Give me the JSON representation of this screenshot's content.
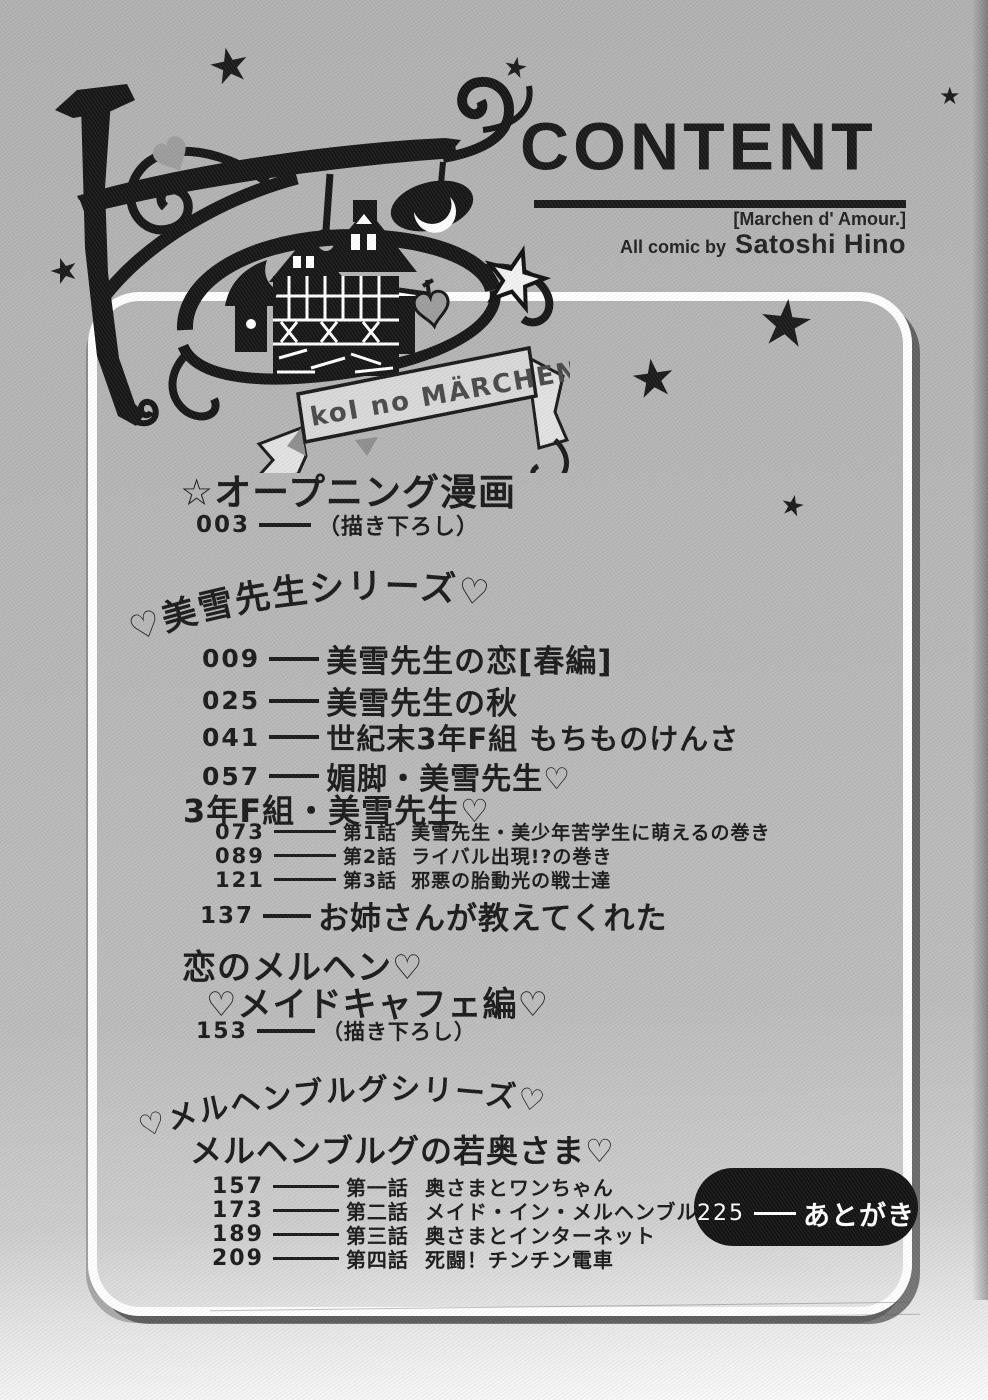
{
  "header": {
    "title": "CONTENT",
    "subtitle": "[Marchen d' Amour.]",
    "byline_prefix": "All comic by",
    "author": "Satoshi Hino"
  },
  "illustration": {
    "banner_text": "koI no MÄRCHEN"
  },
  "icons": {
    "star": "★"
  },
  "colors": {
    "paper": "#b7b7b7",
    "ink": "#1b1b1b",
    "frame": "#ffffff",
    "pill": "#141414",
    "banner_fill": "#d9d9d9",
    "heart_gray": "#9d9d9d"
  },
  "toc": {
    "opening": {
      "title": "☆オープニング漫画",
      "page": "003",
      "note": "（描き下ろし）"
    },
    "miyuki_series": {
      "arc_heading": "♡美雪先生シリーズ♡",
      "items": [
        {
          "page": "009",
          "title": "美雪先生の恋[春編]"
        },
        {
          "page": "025",
          "title": "美雪先生の秋"
        },
        {
          "page": "041",
          "title": "世紀末3年F組 もちものけんさ"
        },
        {
          "page": "057",
          "title": "媚脚・美雪先生♡"
        }
      ],
      "subseries": {
        "title": "3年F組・美雪先生♡",
        "episodes": [
          {
            "page": "073",
            "label": "第1話",
            "title": "美雪先生・美少年苦学生に萌えるの巻き"
          },
          {
            "page": "089",
            "label": "第2話",
            "title": "ライバル出現!?の巻き"
          },
          {
            "page": "121",
            "label": "第3話",
            "title": "邪悪の胎動光の戦士達"
          }
        ]
      },
      "extra": {
        "page": "137",
        "title": "お姉さんが教えてくれた"
      }
    },
    "koi_no_marchen": {
      "title_line1": "恋のメルヘン♡",
      "title_line2": "♡メイドキャフェ編♡",
      "page": "153",
      "note": "（描き下ろし）"
    },
    "marchenburg_series": {
      "arc_heading": "♡メルヘンブルグシリーズ♡",
      "title": "メルヘンブルグの若奥さま♡",
      "episodes": [
        {
          "page": "157",
          "label": "第一話",
          "title": "奥さまとワンちゃん"
        },
        {
          "page": "173",
          "label": "第二話",
          "title": "メイド・イン・メルヘンブルグ"
        },
        {
          "page": "189",
          "label": "第三話",
          "title": "奥さまとインターネット"
        },
        {
          "page": "209",
          "label": "第四話",
          "title": "死闘！チンチン電車"
        }
      ]
    },
    "afterword": {
      "page": "225",
      "title": "あとがき"
    }
  }
}
